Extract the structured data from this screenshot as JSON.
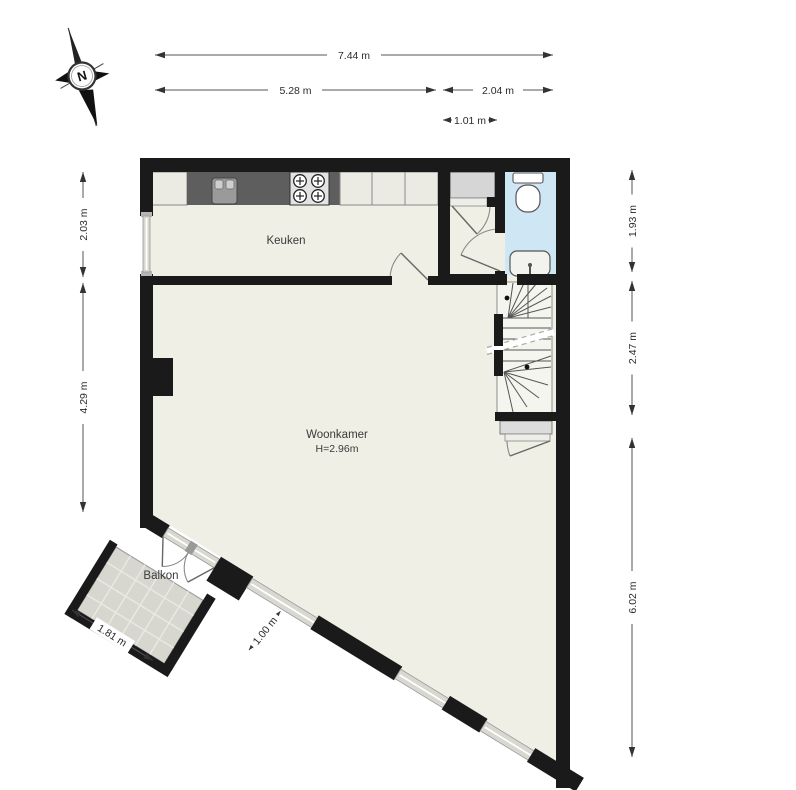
{
  "compass": {
    "label": "N"
  },
  "rooms": {
    "kitchen": {
      "label": "Keuken"
    },
    "living": {
      "label": "Woonkamer",
      "ceiling_height": "H=2.96m"
    },
    "balcony": {
      "label": "Balkon"
    }
  },
  "fixtures": {
    "toilet": "toilet-bowl-with-cistern",
    "hand_basin": "small-sink",
    "kitchen_sink": "double-handle-sink",
    "stove": "four-burner-hob",
    "stairs": "winder-staircase-with-walk-line"
  },
  "dimensions": {
    "total_width": {
      "label": "7.44 m"
    },
    "kitchen_width": {
      "label": "5.28 m"
    },
    "hall_width": {
      "label": "2.04 m"
    },
    "toilet_width": {
      "label": "1.01 m"
    },
    "left_top": {
      "label": "2.03 m"
    },
    "left_bottom": {
      "label": "4.29 m"
    },
    "right_top": {
      "label": "1.93 m"
    },
    "right_middle": {
      "label": "2.47 m"
    },
    "right_bottom": {
      "label": "6.02 m"
    },
    "balcony_width": {
      "label": "1.81 m"
    },
    "balcony_door": {
      "label": "1.00 m"
    }
  },
  "colors": {
    "wall": "#1a1a1a",
    "floor": "#efefe5",
    "toilet_floor": "#cfe7f5",
    "balcony_floor": "#d7d7cf",
    "counter": "#5e5e5e",
    "closet": "#d6d6d6",
    "background": "#ffffff"
  }
}
